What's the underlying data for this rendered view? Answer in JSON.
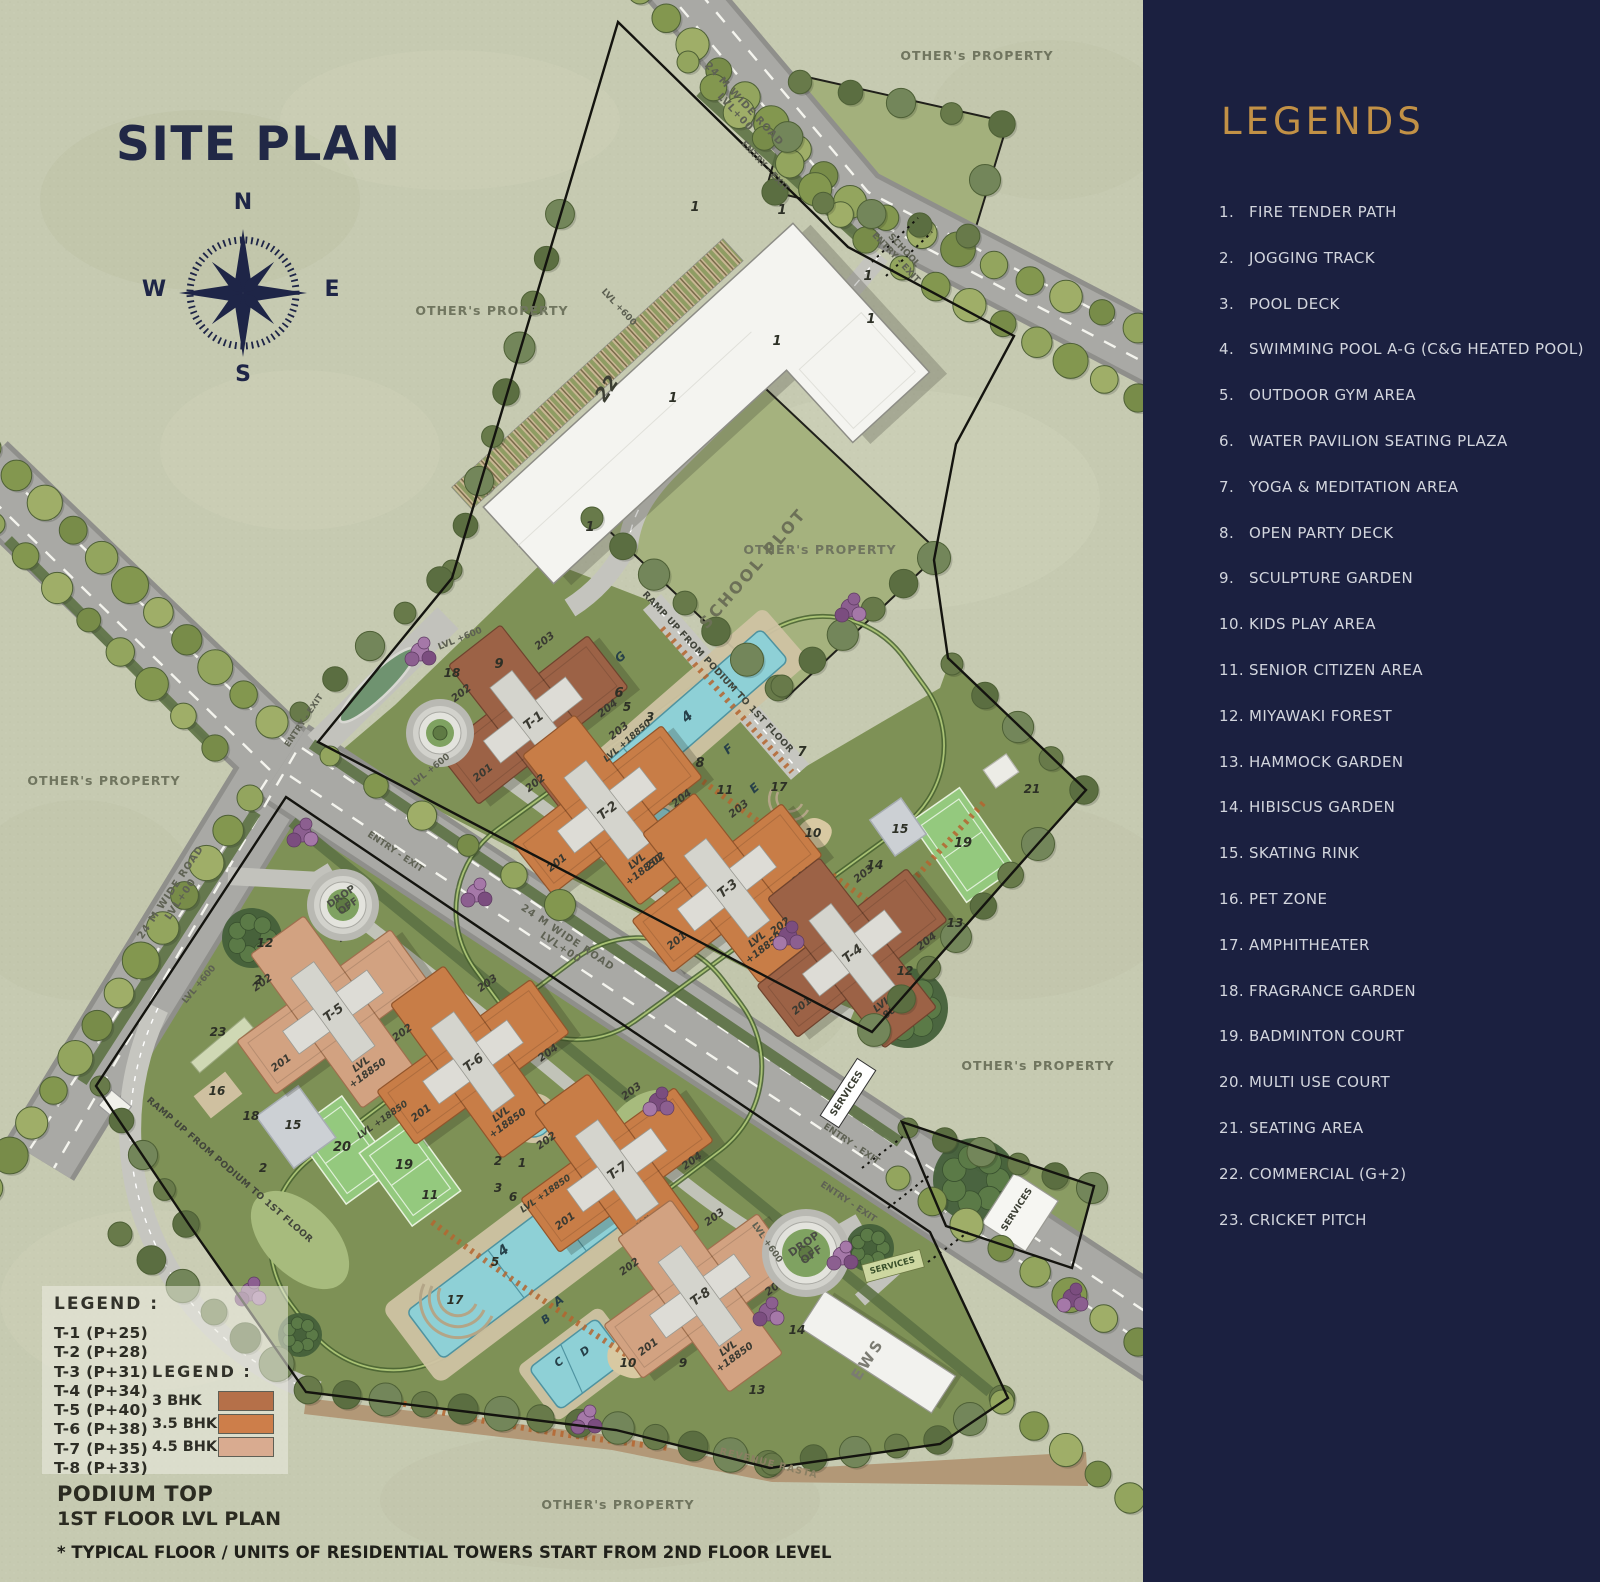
{
  "title": "SITE PLAN",
  "compass": {
    "n": "N",
    "e": "E",
    "s": "S",
    "w": "W"
  },
  "legends_panel": {
    "title": "LEGENDS",
    "items": [
      {
        "num": "1.",
        "label": "FIRE TENDER PATH"
      },
      {
        "num": "2.",
        "label": "JOGGING TRACK"
      },
      {
        "num": "3.",
        "label": "POOL DECK"
      },
      {
        "num": "4.",
        "label": "SWIMMING POOL A-G (C&G HEATED POOL)"
      },
      {
        "num": "5.",
        "label": "OUTDOOR GYM AREA"
      },
      {
        "num": "6.",
        "label": "WATER PAVILION SEATING PLAZA"
      },
      {
        "num": "7.",
        "label": "YOGA & MEDITATION AREA"
      },
      {
        "num": "8.",
        "label": "OPEN PARTY DECK"
      },
      {
        "num": "9.",
        "label": "SCULPTURE GARDEN"
      },
      {
        "num": "10.",
        "label": "KIDS PLAY AREA"
      },
      {
        "num": "11.",
        "label": "SENIOR CITIZEN AREA"
      },
      {
        "num": "12.",
        "label": "MIYAWAKI FOREST"
      },
      {
        "num": "13.",
        "label": "HAMMOCK GARDEN"
      },
      {
        "num": "14.",
        "label": "HIBISCUS GARDEN"
      },
      {
        "num": "15.",
        "label": "SKATING RINK"
      },
      {
        "num": "16.",
        "label": "PET ZONE"
      },
      {
        "num": "17.",
        "label": "AMPHITHEATER"
      },
      {
        "num": "18.",
        "label": "FRAGRANCE GARDEN"
      },
      {
        "num": "19.",
        "label": "BADMINTON COURT"
      },
      {
        "num": "20.",
        "label": "MULTI USE COURT"
      },
      {
        "num": "21.",
        "label": "SEATING AREA"
      },
      {
        "num": "22.",
        "label": "COMMERCIAL (G+2)"
      },
      {
        "num": "23.",
        "label": "CRICKET PITCH"
      }
    ]
  },
  "tower_legend": {
    "header": "LEGEND :",
    "items": [
      "T-1 (P+25)",
      "T-2 (P+28)",
      "T-3 (P+31)",
      "T-4 (P+34)",
      "T-5 (P+40)",
      "T-6 (P+38)",
      "T-7 (P+35)",
      "T-8 (P+33)"
    ]
  },
  "bhk_legend": {
    "header": "LEGEND :",
    "items": [
      {
        "label": "3 BHK",
        "color": "#b57049"
      },
      {
        "label": "3.5 BHK",
        "color": "#cd7e4a"
      },
      {
        "label": "4.5 BHK",
        "color": "#d9ab90"
      }
    ]
  },
  "footer": {
    "podium_top": "PODIUM TOP",
    "floor_plan": "1ST FLOOR LVL PLAN",
    "disclaimer": "* TYPICAL FLOOR / UNITS OF RESIDENTIAL TOWERS START FROM 2ND FLOOR LEVEL"
  },
  "towers": [
    {
      "id": "T-1",
      "type": "3 BHK",
      "units": [
        "201",
        "202",
        "203",
        "204"
      ],
      "level": [
        "LVL",
        "+18850"
      ]
    },
    {
      "id": "T-2",
      "type": "3.5 BHK",
      "units": [
        "201",
        "202",
        "203",
        "204"
      ],
      "level": [
        "LVL",
        "+18850"
      ]
    },
    {
      "id": "T-3",
      "type": "3.5 BHK",
      "units": [
        "201",
        "202",
        "203",
        "204"
      ],
      "level": [
        "LVL",
        "+18850"
      ]
    },
    {
      "id": "T-4",
      "type": "3 BHK",
      "units": [
        "201",
        "202",
        "203",
        "204"
      ],
      "level": [
        "LVL",
        "+18850"
      ]
    },
    {
      "id": "T-5",
      "type": "4.5 BHK",
      "units": [
        "201",
        "202",
        "203",
        "204"
      ],
      "level": [
        "LVL",
        "+18850"
      ]
    },
    {
      "id": "T-6",
      "type": "3.5 BHK",
      "units": [
        "201",
        "202",
        "203",
        "204"
      ],
      "level": [
        "LVL",
        "+18850"
      ]
    },
    {
      "id": "T-7",
      "type": "3.5 BHK",
      "units": [
        "201",
        "202",
        "203",
        "204"
      ],
      "level": [
        "LVL",
        "+18850"
      ]
    },
    {
      "id": "T-8",
      "type": "4.5 BHK",
      "units": [
        "201",
        "202",
        "203",
        "204"
      ],
      "level": [
        "LVL",
        "+18850"
      ]
    }
  ],
  "map_labels": [
    {
      "n": "site-plan-title",
      "t": "SITE PLAN",
      "x": 116,
      "y": 160,
      "s": 47,
      "w": 700,
      "c": "#212846",
      "ls": 1.5,
      "a": "start"
    },
    {
      "n": "compass-n",
      "t": "N",
      "x": 243,
      "y": 209,
      "s": 22,
      "w": 700,
      "c": "#1e2547"
    },
    {
      "n": "compass-e",
      "t": "E",
      "x": 332,
      "y": 296,
      "s": 22,
      "w": 700,
      "c": "#1e2547"
    },
    {
      "n": "compass-s",
      "t": "S",
      "x": 243,
      "y": 381,
      "s": 22,
      "w": 700,
      "c": "#1e2547"
    },
    {
      "n": "compass-w",
      "t": "W",
      "x": 154,
      "y": 296,
      "s": 22,
      "w": 700,
      "c": "#1e2547"
    },
    {
      "n": "others-property",
      "t": "OTHER's PROPERTY",
      "x": 977,
      "y": 60,
      "s": 12.5,
      "c": "#70755f",
      "ls": 1,
      "w": 600
    },
    {
      "n": "others-property",
      "t": "OTHER's PROPERTY",
      "x": 492,
      "y": 315,
      "s": 12.5,
      "c": "#70755f",
      "ls": 1,
      "w": 600
    },
    {
      "n": "others-property",
      "t": "OTHER's PROPERTY",
      "x": 820,
      "y": 554,
      "s": 12.5,
      "c": "#70755f",
      "ls": 1,
      "w": 600
    },
    {
      "n": "others-property",
      "t": "OTHER's PROPERTY",
      "x": 104,
      "y": 785,
      "s": 12.5,
      "c": "#70755f",
      "ls": 1,
      "w": 600
    },
    {
      "n": "others-property",
      "t": "OTHER's PROPERTY",
      "x": 1038,
      "y": 1070,
      "s": 12.5,
      "c": "#70755f",
      "ls": 1,
      "w": 600
    },
    {
      "n": "others-property",
      "t": "OTHER's PROPERTY",
      "x": 618,
      "y": 1509,
      "s": 12.5,
      "c": "#70755f",
      "ls": 1,
      "w": 600
    },
    {
      "n": "road-label",
      "lines": [
        "24 M WIDE ROAD",
        "LVL+00"
      ],
      "x": 742,
      "y": 106,
      "r": 47,
      "s": 10,
      "c": "#5f6254",
      "w": 600,
      "ls": 1
    },
    {
      "n": "road-label",
      "t": "ENTRY - EXIT",
      "x": 763,
      "y": 168,
      "r": 47,
      "s": 9,
      "c": "#5f6254",
      "w": 600
    },
    {
      "n": "road-label",
      "lines": [
        "SCHOOL",
        "ENTRY - EXIT"
      ],
      "x": 902,
      "y": 252,
      "r": 47,
      "s": 9,
      "c": "#5f6254",
      "w": 600
    },
    {
      "n": "road-label",
      "lines": [
        "24 M WIDE ROAD",
        "LVL+00"
      ],
      "x": 566,
      "y": 940,
      "r": 34,
      "s": 10,
      "c": "#5f6254",
      "w": 600,
      "ls": 1
    },
    {
      "n": "road-label",
      "lines": [
        "24 M WIDE ROAD",
        "LVL+00"
      ],
      "x": 173,
      "y": 894,
      "r": -56,
      "s": 10,
      "c": "#5f6254",
      "w": 600,
      "ls": 1
    },
    {
      "n": "road-label",
      "t": "ENTRY - EXIT",
      "x": 306,
      "y": 722,
      "r": -56,
      "s": 8.5,
      "c": "#5f6254",
      "w": 600
    },
    {
      "n": "road-label",
      "t": "ENTRY - EXIT",
      "x": 394,
      "y": 854,
      "r": 34,
      "s": 9,
      "c": "#5f6254",
      "w": 600
    },
    {
      "n": "road-label",
      "t": "ENTRY - EXIT",
      "x": 850,
      "y": 1146,
      "r": 34,
      "s": 9,
      "c": "#5f6254",
      "w": 600
    },
    {
      "n": "road-label",
      "t": "ENTRY - EXIT",
      "x": 847,
      "y": 1204,
      "r": 34,
      "s": 9,
      "c": "#5f6254",
      "w": 600
    },
    {
      "n": "level-label",
      "t": "LVL +600",
      "x": 617,
      "y": 309,
      "r": 47,
      "s": 9,
      "c": "#5d6052",
      "w": 600
    },
    {
      "n": "level-label",
      "t": "LVL +600",
      "x": 432,
      "y": 772,
      "r": -38,
      "s": 9,
      "c": "#5d6052",
      "w": 600
    },
    {
      "n": "level-label",
      "t": "LVL +600",
      "x": 461,
      "y": 641,
      "r": -22,
      "s": 9,
      "c": "#5d6052",
      "w": 600
    },
    {
      "n": "level-label",
      "t": "LVL +600",
      "x": 201,
      "y": 986,
      "r": -50,
      "s": 9,
      "c": "#5d6052",
      "w": 600
    },
    {
      "n": "level-label",
      "t": "LVL +600",
      "x": 765,
      "y": 1244,
      "r": 55,
      "s": 9,
      "c": "#5d6052",
      "w": 600
    },
    {
      "n": "school-plot-label",
      "t": "SCHOOL PLOT",
      "x": 757,
      "y": 572,
      "r": -49,
      "s": 16,
      "c": "#6c7057",
      "ls": 2.5,
      "w": 600
    },
    {
      "n": "commercial-22",
      "t": "22",
      "x": 612,
      "y": 392,
      "r": -56,
      "s": 19,
      "w": 700,
      "i": 1,
      "c": "#3c3f33"
    },
    {
      "n": "ramp-label",
      "t": "RAMP UP FROM PODIUM TO 1ST FLOOR",
      "x": 716,
      "y": 674,
      "r": 47,
      "s": 9.2,
      "w": 600,
      "c": "#42453b",
      "ls": 0.4
    },
    {
      "n": "ramp-label",
      "t": "RAMP UP FROM PODIUM TO 1ST FLOOR",
      "x": 228,
      "y": 1172,
      "r": 41,
      "s": 9.2,
      "w": 600,
      "c": "#42453b",
      "ls": 0.4
    },
    {
      "n": "drop-off-label",
      "lines": [
        "DROP",
        "OFF"
      ],
      "x": 343,
      "y": 899,
      "r": -35,
      "s": 10,
      "w": 700,
      "c": "#4b4e45"
    },
    {
      "n": "drop-off-label",
      "lines": [
        "DROP",
        "OFF"
      ],
      "x": 806,
      "y": 1247,
      "r": -35,
      "s": 11,
      "w": 700,
      "c": "#4b4e45"
    },
    {
      "n": "services-label",
      "t": "SERVICES",
      "x": 849,
      "y": 1095,
      "r": -57,
      "s": 9.5,
      "w": 700,
      "c": "#3b3e33"
    },
    {
      "n": "services-label",
      "t": "SERVICES",
      "x": 1019,
      "y": 1211,
      "r": -57,
      "s": 9,
      "w": 700,
      "c": "#3b3e33"
    },
    {
      "n": "services-label",
      "t": "SERVICES",
      "x": 893,
      "y": 1268,
      "r": -15,
      "s": 8.5,
      "w": 700,
      "c": "#39502a"
    },
    {
      "n": "ews-label",
      "t": "EWS",
      "x": 872,
      "y": 1362,
      "r": -57,
      "s": 15,
      "c": "#7b7b72",
      "ls": 3,
      "w": 600
    },
    {
      "n": "revenue-rasta",
      "t": "REVENUE RASTA",
      "x": 768,
      "y": 1466,
      "r": 14,
      "s": 9.5,
      "c": "#8a7f63",
      "ls": 1,
      "w": 600
    },
    {
      "n": "podium-level",
      "t": "LVL +18850",
      "x": 384,
      "y": 1122,
      "r": -35,
      "s": 9,
      "w": 700,
      "i": 1,
      "c": "#3c3f34"
    },
    {
      "n": "podium-level",
      "t": "LVL +18850",
      "x": 547,
      "y": 1196,
      "r": -35,
      "s": 9,
      "w": 700,
      "i": 1,
      "c": "#3c3f34"
    },
    {
      "n": "podium-level",
      "t": "LVL +18850",
      "x": 629,
      "y": 743,
      "r": -41,
      "s": 9,
      "w": 700,
      "i": 1,
      "c": "#3c3f34"
    },
    {
      "n": "pool-letter",
      "t": "G",
      "x": 623,
      "y": 660,
      "r": -41,
      "s": 12,
      "w": 700,
      "i": 1,
      "c": "#274049"
    },
    {
      "n": "pool-letter",
      "t": "4",
      "x": 690,
      "y": 720,
      "r": -41,
      "s": 14,
      "w": 700,
      "i": 1,
      "c": "#274049"
    },
    {
      "n": "pool-letter",
      "t": "F",
      "x": 731,
      "y": 752,
      "r": -41,
      "s": 12,
      "w": 700,
      "i": 1,
      "c": "#274049"
    },
    {
      "n": "pool-letter",
      "t": "E",
      "x": 757,
      "y": 791,
      "r": -41,
      "s": 12,
      "w": 700,
      "i": 1,
      "c": "#274049"
    },
    {
      "n": "pool-letter",
      "t": "4",
      "x": 506,
      "y": 1254,
      "r": -37,
      "s": 14,
      "w": 700,
      "i": 1,
      "c": "#274049"
    },
    {
      "n": "pool-letter",
      "t": "A",
      "x": 561,
      "y": 1304,
      "r": -37,
      "s": 12,
      "w": 700,
      "i": 1,
      "c": "#274049"
    },
    {
      "n": "pool-letter",
      "t": "B",
      "x": 548,
      "y": 1322,
      "r": -37,
      "s": 11,
      "w": 700,
      "i": 1,
      "c": "#274049"
    },
    {
      "n": "pool-letter",
      "t": "C",
      "x": 561,
      "y": 1365,
      "r": -37,
      "s": 11,
      "w": 700,
      "i": 1,
      "c": "#274049"
    },
    {
      "n": "pool-letter",
      "t": "D",
      "x": 587,
      "y": 1354,
      "r": -37,
      "s": 11,
      "w": 700,
      "i": 1,
      "c": "#274049"
    },
    {
      "n": "num-marker",
      "t": "1",
      "x": 695,
      "y": 211,
      "s": 13,
      "w": 700,
      "i": 1
    },
    {
      "n": "num-marker",
      "t": "1",
      "x": 782,
      "y": 214,
      "s": 13,
      "w": 700,
      "i": 1
    },
    {
      "n": "num-marker",
      "t": "1",
      "x": 868,
      "y": 280,
      "s": 13,
      "w": 700,
      "i": 1
    },
    {
      "n": "num-marker",
      "t": "1",
      "x": 871,
      "y": 323,
      "s": 13,
      "w": 700,
      "i": 1
    },
    {
      "n": "num-marker",
      "t": "1",
      "x": 777,
      "y": 345,
      "s": 13,
      "w": 700,
      "i": 1
    },
    {
      "n": "num-marker",
      "t": "1",
      "x": 673,
      "y": 402,
      "s": 13,
      "w": 700,
      "i": 1
    },
    {
      "n": "num-marker",
      "t": "1",
      "x": 590,
      "y": 531,
      "s": 13,
      "w": 700,
      "i": 1
    },
    {
      "n": "num-marker",
      "t": "1",
      "x": 522,
      "y": 1167,
      "s": 12,
      "w": 700,
      "i": 1
    },
    {
      "n": "num-marker",
      "t": "2",
      "x": 258,
      "y": 984,
      "s": 12,
      "w": 700,
      "i": 1
    },
    {
      "n": "num-marker",
      "t": "2",
      "x": 498,
      "y": 1165,
      "s": 12,
      "w": 700,
      "i": 1
    },
    {
      "n": "num-marker",
      "t": "2",
      "x": 263,
      "y": 1172,
      "s": 12,
      "w": 700,
      "i": 1
    },
    {
      "n": "num-marker",
      "t": "9",
      "x": 499,
      "y": 668,
      "s": 13,
      "w": 700,
      "i": 1
    },
    {
      "n": "num-marker",
      "t": "6",
      "x": 619,
      "y": 697,
      "s": 13,
      "w": 700,
      "i": 1
    },
    {
      "n": "num-marker",
      "t": "5",
      "x": 627,
      "y": 711,
      "s": 12,
      "w": 700,
      "i": 1
    },
    {
      "n": "num-marker",
      "t": "3",
      "x": 650,
      "y": 721,
      "s": 12,
      "w": 700,
      "i": 1
    },
    {
      "n": "num-marker",
      "t": "8",
      "x": 700,
      "y": 767,
      "s": 13,
      "w": 700,
      "i": 1
    },
    {
      "n": "num-marker",
      "t": "11",
      "x": 725,
      "y": 794,
      "s": 12,
      "w": 700,
      "i": 1
    },
    {
      "n": "num-marker",
      "t": "17",
      "x": 779,
      "y": 791,
      "s": 12,
      "w": 700,
      "i": 1
    },
    {
      "n": "num-marker",
      "t": "7",
      "x": 802,
      "y": 756,
      "s": 13,
      "w": 700,
      "i": 1
    },
    {
      "n": "num-marker",
      "t": "10",
      "x": 813,
      "y": 837,
      "s": 12,
      "w": 700,
      "i": 1
    },
    {
      "n": "num-marker",
      "t": "14",
      "x": 875,
      "y": 869,
      "s": 12,
      "w": 700,
      "i": 1
    },
    {
      "n": "num-marker",
      "t": "15",
      "x": 900,
      "y": 833,
      "s": 12,
      "w": 700,
      "i": 1
    },
    {
      "n": "num-marker",
      "t": "19",
      "x": 963,
      "y": 847,
      "s": 13,
      "w": 700,
      "i": 1
    },
    {
      "n": "num-marker",
      "t": "21",
      "x": 1032,
      "y": 793,
      "s": 12,
      "w": 700,
      "i": 1
    },
    {
      "n": "num-marker",
      "t": "12",
      "x": 905,
      "y": 975,
      "s": 12,
      "w": 700,
      "i": 1
    },
    {
      "n": "num-marker",
      "t": "13",
      "x": 955,
      "y": 927,
      "s": 12,
      "w": 700,
      "i": 1
    },
    {
      "n": "num-marker",
      "t": "18",
      "x": 452,
      "y": 677,
      "s": 12,
      "w": 700,
      "i": 1
    },
    {
      "n": "num-marker",
      "t": "12",
      "x": 265,
      "y": 947,
      "s": 12,
      "w": 700,
      "i": 1
    },
    {
      "n": "num-marker",
      "t": "23",
      "x": 218,
      "y": 1036,
      "s": 12,
      "w": 700,
      "i": 1
    },
    {
      "n": "num-marker",
      "t": "16",
      "x": 217,
      "y": 1095,
      "s": 12,
      "w": 700,
      "i": 1
    },
    {
      "n": "num-marker",
      "t": "18",
      "x": 251,
      "y": 1120,
      "s": 12,
      "w": 700,
      "i": 1
    },
    {
      "n": "num-marker",
      "t": "15",
      "x": 293,
      "y": 1129,
      "s": 12,
      "w": 700,
      "i": 1
    },
    {
      "n": "num-marker",
      "t": "20",
      "x": 342,
      "y": 1151,
      "s": 13,
      "w": 700,
      "i": 1
    },
    {
      "n": "num-marker",
      "t": "19",
      "x": 404,
      "y": 1169,
      "s": 13,
      "w": 700,
      "i": 1
    },
    {
      "n": "num-marker",
      "t": "3",
      "x": 498,
      "y": 1192,
      "s": 12,
      "w": 700,
      "i": 1
    },
    {
      "n": "num-marker",
      "t": "6",
      "x": 513,
      "y": 1201,
      "s": 12,
      "w": 700,
      "i": 1
    },
    {
      "n": "num-marker",
      "t": "11",
      "x": 430,
      "y": 1199,
      "s": 12,
      "w": 700,
      "i": 1
    },
    {
      "n": "num-marker",
      "t": "5",
      "x": 495,
      "y": 1266,
      "s": 12,
      "w": 700,
      "i": 1
    },
    {
      "n": "num-marker",
      "t": "17",
      "x": 455,
      "y": 1304,
      "s": 12,
      "w": 700,
      "i": 1
    },
    {
      "n": "num-marker",
      "t": "10",
      "x": 628,
      "y": 1367,
      "s": 12,
      "w": 700,
      "i": 1
    },
    {
      "n": "num-marker",
      "t": "9",
      "x": 683,
      "y": 1367,
      "s": 12,
      "w": 700,
      "i": 1
    },
    {
      "n": "num-marker",
      "t": "13",
      "x": 757,
      "y": 1394,
      "s": 12,
      "w": 700,
      "i": 1
    },
    {
      "n": "num-marker",
      "t": "14",
      "x": 797,
      "y": 1334,
      "s": 12,
      "w": 700,
      "i": 1
    }
  ]
}
